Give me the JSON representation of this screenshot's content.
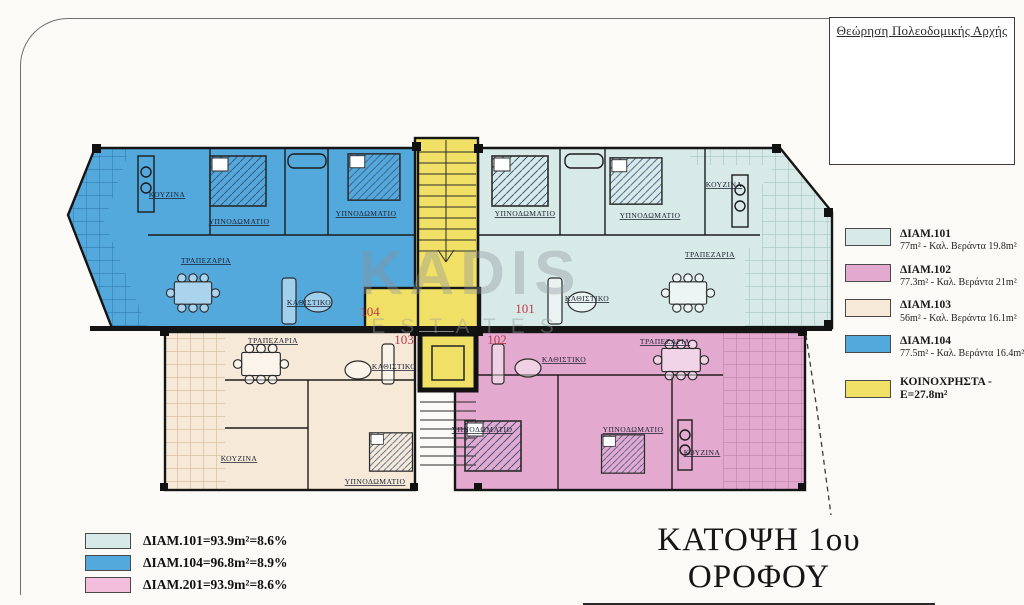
{
  "approval_box": {
    "title": "Θεώρηση Πολεοδομικής Αρχής"
  },
  "watermark": {
    "line1": "KADIS",
    "line2": "ESTATES"
  },
  "title_block": {
    "title": "ΚΑΤΟΨΗ 1ου ΟΡΟΦΟΥ"
  },
  "area_legend": {
    "items": [
      {
        "name": "ΔΙΑΜ.101",
        "detail": "77m² - Καλ. Βεράντα 19.8m²",
        "color": "#d8eae8"
      },
      {
        "name": "ΔΙΑΜ.102",
        "detail": "77.3m² - Καλ. Βεράντα 21m²",
        "color": "#e3a9cf"
      },
      {
        "name": "ΔΙΑΜ.103",
        "detail": "56m² - Καλ. Βεράντα 16.1m²",
        "color": "#f6e9d8"
      },
      {
        "name": "ΔΙΑΜ.104",
        "detail": "77.5m² - Καλ. Βεράντα 16.4m²",
        "color": "#54a9dc"
      },
      {
        "name": "ΚΟΙΝΟΧΡΗΣΤΑ - E=27.8m²",
        "detail": "",
        "color": "#f1e066"
      }
    ]
  },
  "ratio_legend": {
    "items": [
      {
        "label": "ΔΙΑΜ.101=93.9m²=8.6%",
        "color": "#d8eae8"
      },
      {
        "label": "ΔΙΑΜ.104=96.8m²=8.9%",
        "color": "#54a9dc"
      },
      {
        "label": "ΔΙΑΜ.201=93.9m²=8.6%",
        "color": "#f2bedb"
      }
    ]
  },
  "plan": {
    "colors": {
      "apt101": "#d8eae8",
      "apt102": "#e3a9cf",
      "apt103": "#f6e9d8",
      "apt104": "#54a9dc",
      "common": "#f1e066",
      "number": "#bf3a4a",
      "wall": "#151515"
    },
    "apartments": [
      {
        "number": "104",
        "rooms": [
          "ΚΟΥΖΙΝΑ",
          "ΥΠΝΟΔΩΜΑΤΙΟ",
          "ΥΠΝΟΔΩΜΑΤΙΟ",
          "ΤΡΑΠΕΖΑΡΙΑ",
          "ΚΑΘΙΣΤΙΚΟ"
        ]
      },
      {
        "number": "101",
        "rooms": [
          "ΥΠΝΟΔΩΜΑΤΙΟ",
          "ΥΠΝΟΔΩΜΑΤΙΟ",
          "ΚΟΥΖΙΝΑ",
          "ΤΡΑΠΕΖΑΡΙΑ",
          "ΚΑΘΙΣΤΙΚΟ"
        ]
      },
      {
        "number": "103",
        "rooms": [
          "ΤΡΑΠΕΖΑΡΙΑ",
          "ΚΑΘΙΣΤΙΚΟ",
          "ΚΟΥΖΙΝΑ",
          "ΥΠΝΟΔΩΜΑΤΙΟ"
        ]
      },
      {
        "number": "102",
        "rooms": [
          "ΚΑΘΙΣΤΙΚΟ",
          "ΤΡΑΠΕΖΑΡΙΑ",
          "ΥΠΝΟΔΩΜΑΤΙΟ",
          "ΥΠΝΟΔΩΜΑΤΙΟ",
          "ΚΟΥΖΙΝΑ"
        ]
      }
    ]
  }
}
